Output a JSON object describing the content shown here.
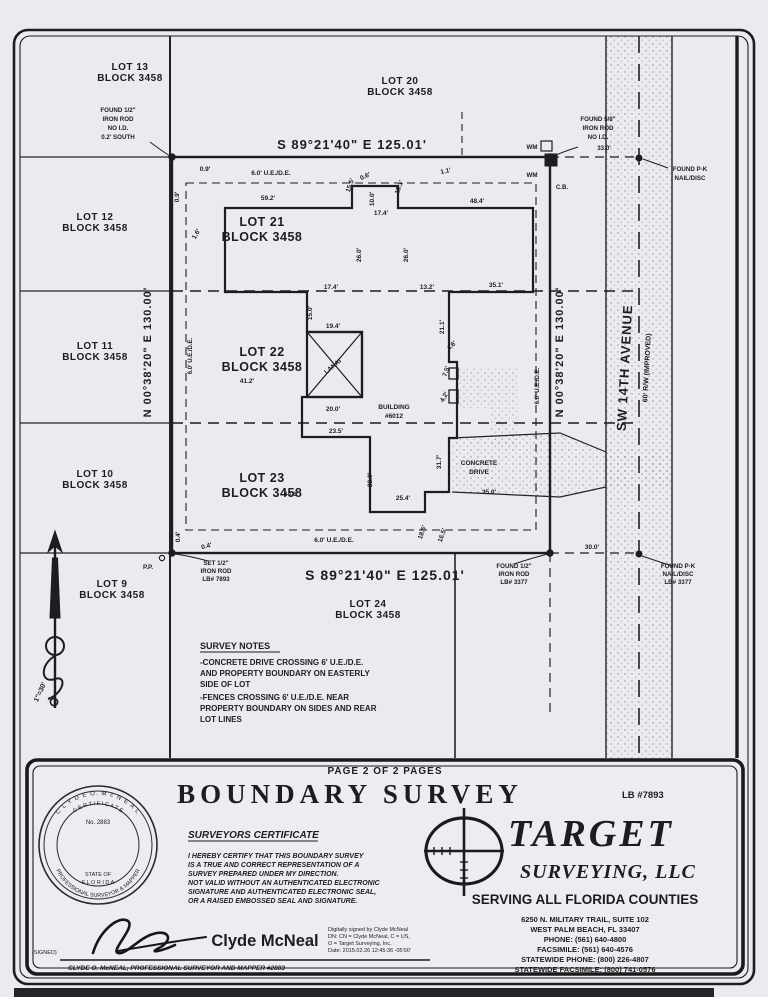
{
  "drawing": {
    "scale": "1\"=30'",
    "bearing_top": "S 89°21'40\" E  125.01'",
    "bearing_bottom": "S 89°21'40\" E  125.01'",
    "bearing_west": "N 00°38'20\" E  130.00'",
    "bearing_east": "N 00°38'20\" E  130.00'",
    "street_name": "SW 14TH AVENUE",
    "street_rw": "60' R/W (IMPROVED)",
    "adjacent_lots": [
      {
        "name": "LOT 13",
        "block": "BLOCK 3458"
      },
      {
        "name": "LOT 20",
        "block": "BLOCK 3458"
      },
      {
        "name": "LOT 12",
        "block": "BLOCK 3458"
      },
      {
        "name": "LOT 11",
        "block": "BLOCK 3458"
      },
      {
        "name": "LOT 10",
        "block": "BLOCK 3458"
      },
      {
        "name": "LOT 9",
        "block": "BLOCK 3458"
      },
      {
        "name": "LOT 24",
        "block": "BLOCK 3458"
      }
    ],
    "subject_lots": [
      {
        "name": "LOT 21",
        "block": "BLOCK 3458"
      },
      {
        "name": "LOT 22",
        "block": "BLOCK 3458"
      },
      {
        "name": "LOT 23",
        "block": "BLOCK 3458"
      }
    ],
    "building": [
      "BUILDING",
      "#6012"
    ],
    "lanai": "LANAI",
    "drive": [
      "CONCRETE",
      "DRIVE"
    ],
    "pp": "P.P.",
    "wm": "WM",
    "cb": "C.B.",
    "monuments": {
      "nw": [
        "FOUND 1/2\"",
        "IRON ROD",
        "NO I.D.",
        "0.2' SOUTH"
      ],
      "ne": [
        "FOUND 5/8\"",
        "IRON ROD",
        "NO I.D.",
        "33.0'"
      ],
      "ne_pk": [
        "FOUND P-K",
        "NAIL/DISC"
      ],
      "sw": [
        "SET 1/2\"",
        "IRON ROD",
        "LB# 7893"
      ],
      "s": [
        "FOUND 1/2\"",
        "IRON ROD",
        "LB# 3377"
      ],
      "se_pk": [
        "FOUND P-K",
        "NAIL/DISC",
        "LB# 3377"
      ]
    },
    "dims": [
      "0.9'",
      "0.9'",
      "6.0' U.E./D.E.",
      "59.2'",
      "15.5'",
      "0.6'",
      "10.0'",
      "15.1'",
      "1.1'",
      "48.4'",
      "17.4'",
      "26.0'",
      "26.0'",
      "35.1'",
      "17.4'",
      "13.2'",
      "15.0'",
      "21.1'",
      "19.4'",
      "20.0'",
      "41.2'",
      "1.6'",
      "6.0' U.E./D.E.",
      "7.5'",
      "4.6'",
      "4.2'",
      "23.5'",
      "22.0'",
      "31.7'",
      "25.4'",
      "64.6'",
      "35.0'",
      "6.0' U.E./D.E.",
      "18.5'",
      "16.5'",
      "0.4'",
      "0.4'",
      "30.0'",
      "6.0' U.E./D.E."
    ],
    "notes_title": "SURVEY NOTES",
    "notes": [
      "-CONCRETE DRIVE CROSSING 6' U.E./D.E.",
      "AND PROPERTY BOUNDARY ON EASTERLY",
      "SIDE OF LOT",
      "-FENCES CROSSING 6' U.E./D.E. NEAR",
      "PROPERTY BOUNDARY ON SIDES AND REAR",
      "LOT LINES"
    ]
  },
  "titleblock": {
    "page_of": "PAGE 2 OF 2 PAGES",
    "title": "BOUNDARY SURVEY",
    "lb": "LB #7893",
    "cert_title": "SURVEYORS CERTIFICATE",
    "cert_lines": [
      "I HEREBY CERTIFY THAT THIS BOUNDARY SURVEY",
      "IS A TRUE AND CORRECT REPRESENTATION OF A",
      "SURVEY PREPARED UNDER MY DIRECTION.",
      "NOT VALID WITHOUT AN AUTHENTICATED ELECTRONIC",
      "SIGNATURE AND AUTHENTICATED ELECTRONIC SEAL,",
      "OR A RAISED EMBOSSED SEAL AND SIGNATURE."
    ],
    "company": {
      "name": "TARGET",
      "sub": "SURVEYING,  LLC",
      "tagline": "SERVING ALL FLORIDA COUNTIES",
      "address": [
        "6250 N. MILITARY TRAIL, SUITE 102",
        "WEST PALM BEACH, FL 33407",
        "PHONE:  (561) 640-4800",
        "FACSIMILE:  (561) 640-4576",
        "STATEWIDE PHONE:  (800) 226-4807",
        "STATEWIDE FACSIMILE:  (800) 741-0576"
      ]
    },
    "signature": {
      "signed": "(SIGNED)",
      "printed": "Clyde McNeal",
      "digital": [
        "Digitally signed by Clyde McNeal",
        "DN: CN = Clyde McNeal, C = US,",
        "O = Target Surveying, Inc.",
        "Date: 2015.02.26 12:45:36 -05'00'"
      ],
      "title_line": "CLYDE O. McNEAL, PROFESSIONAL SURVEYOR AND MAPPER #2883"
    },
    "seal": {
      "arc_top": "C L Y D E   O.   M c N E A L",
      "arc_top2": "C E R T I F I C A T E",
      "number": "No. 2883",
      "state": "STATE OF",
      "state2": "F L O R I D A",
      "arc_bottom": "PROFESSIONAL  SURVEYOR  &  MAPPER"
    }
  }
}
